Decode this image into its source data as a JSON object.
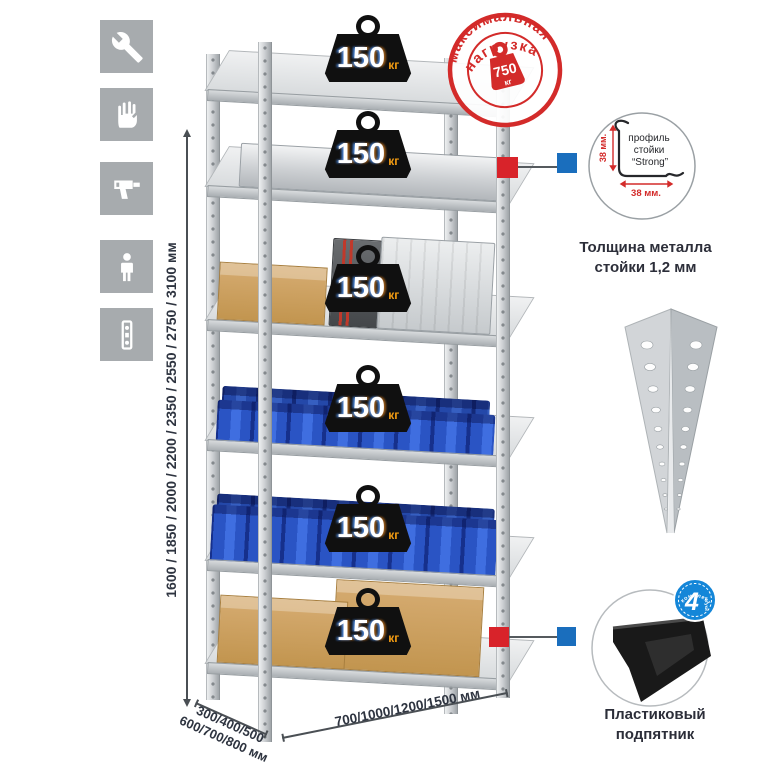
{
  "colors": {
    "stamp_red": "#d32b2a",
    "marker_red": "#d8232a",
    "marker_blue": "#1a6ebd",
    "bin_blue": "#2a54c4",
    "badge_unit_orange": "#f39c12",
    "metal_gray": "#c9ccce"
  },
  "left_icons": [
    {
      "name": "wrench-icon"
    },
    {
      "name": "gloves-icon"
    },
    {
      "name": "drill-icon"
    },
    {
      "name": "person-icon"
    },
    {
      "name": "perforated-post-icon"
    }
  ],
  "height_dimension": {
    "label": "1600 / 1850 / 2000 / 2200 / 2350 / 2550 / 2750 / 3100 мм"
  },
  "max_load_stamp": {
    "arc_top": "максимальная",
    "arc_bottom": "нагрузка",
    "value": "750",
    "unit": "кг"
  },
  "shelves": [
    {
      "load": "150",
      "unit": "кг"
    },
    {
      "load": "150",
      "unit": "кг"
    },
    {
      "load": "150",
      "unit": "кг"
    },
    {
      "load": "150",
      "unit": "кг"
    },
    {
      "load": "150",
      "unit": "кг"
    },
    {
      "load": "150",
      "unit": "кг"
    }
  ],
  "profile_detail": {
    "label_line1": "профиль",
    "label_line2": "стойки",
    "label_line3": "“Strong”",
    "vertical_dim": "38 мм.",
    "horizontal_dim": "38 мм.",
    "caption_line1": "Толщина металла",
    "caption_line2": "стойки 1,2 мм"
  },
  "foot_detail": {
    "badge_number": "4",
    "badge_word": "штуки",
    "badge_arc": "в комплекте",
    "caption_line1": "Пластиковый",
    "caption_line2": "подпятник"
  },
  "depth_dimension": {
    "line1": "300/400/500",
    "line2": "600/700/800 мм"
  },
  "width_dimension": {
    "label": "700/1000/1200/1500 мм"
  }
}
